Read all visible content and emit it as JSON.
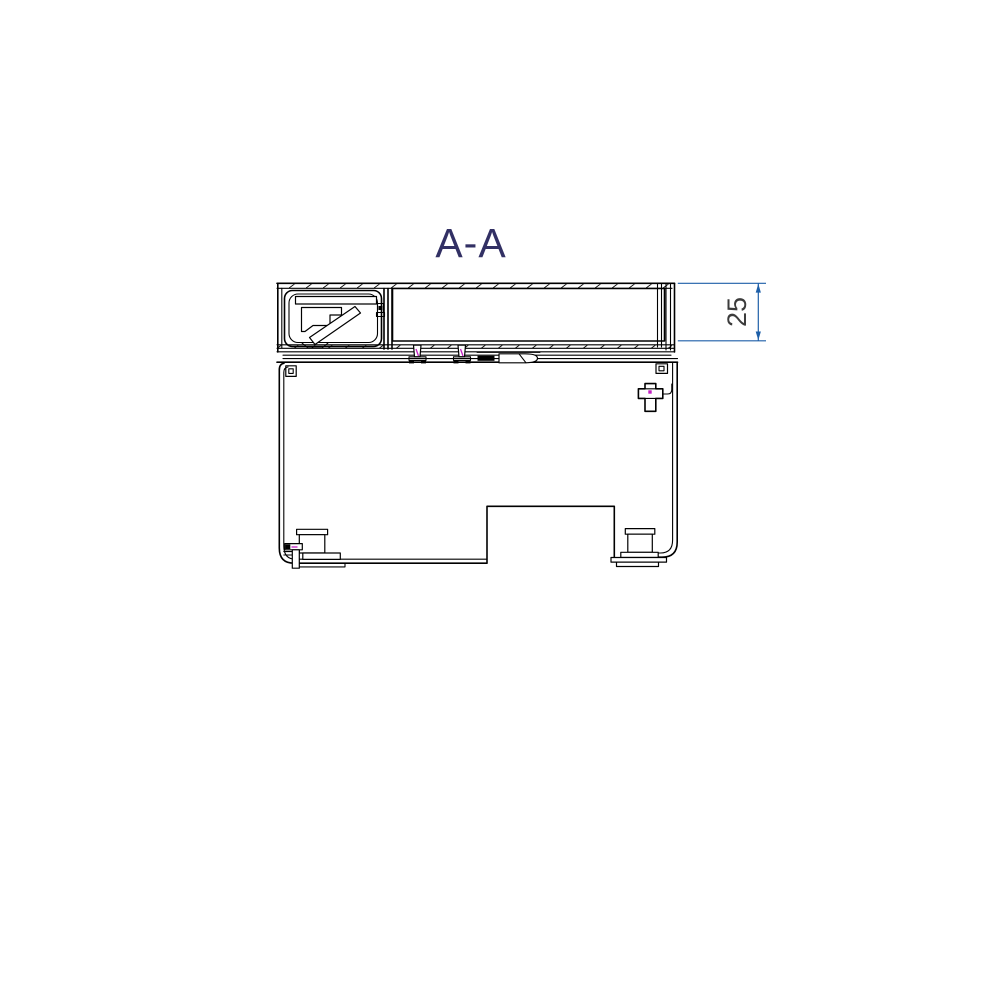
{
  "drawing": {
    "view_label": "A-A",
    "dimension_25": {
      "value": "25",
      "orientation": "vertical",
      "side": "right"
    },
    "colors": {
      "background": "#ffffff",
      "line_black": "#000000",
      "dimension_blue": "#1e5fa8",
      "dimension_text_gray": "#3c3c3c",
      "view_label_navy": "#323064",
      "detail_magenta": "#c21fc2"
    }
  }
}
